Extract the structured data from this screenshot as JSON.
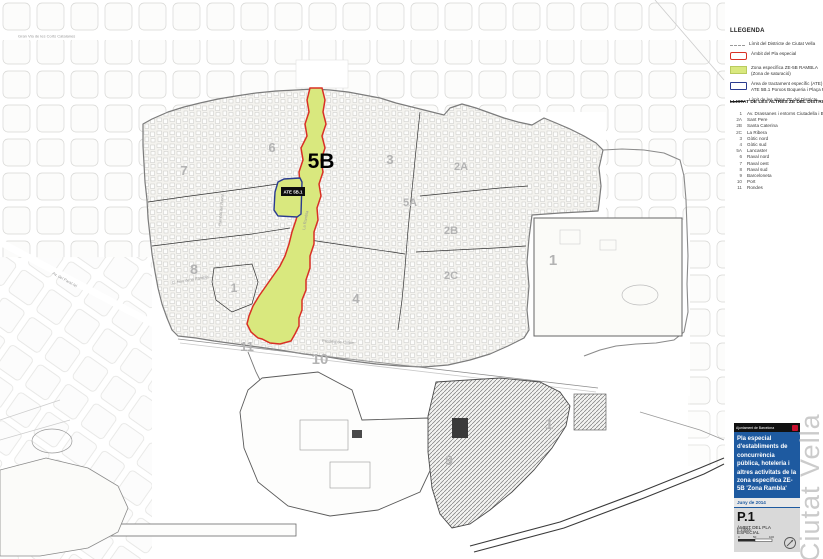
{
  "map": {
    "primary_zone_label": "5B",
    "ate_box_label": "ATE 5B.1",
    "zone_labels": [
      {
        "label": "6"
      },
      {
        "label": "7"
      },
      {
        "label": "8"
      },
      {
        "label": "1"
      },
      {
        "label": "11"
      },
      {
        "label": "10"
      },
      {
        "label": "3"
      },
      {
        "label": "5A"
      },
      {
        "label": "2A"
      },
      {
        "label": "2B"
      },
      {
        "label": "2C"
      },
      {
        "label": "4"
      },
      {
        "label": "1"
      },
      {
        "label": "1"
      },
      {
        "label": "9"
      }
    ],
    "street_labels": [
      {
        "name": "Gran Via de les Corts Catalanes"
      },
      {
        "name": "Rambla del Raval"
      },
      {
        "name": "La Rambla"
      },
      {
        "name": "C. Nou de la Rambla"
      },
      {
        "name": "Passeig de Colom"
      },
      {
        "name": "Av. del Paral·lel"
      }
    ]
  },
  "legend": {
    "title": "LLEGENDA",
    "items": [
      {
        "label": "Límit del Districte de Ciutat Vella",
        "label2": ""
      },
      {
        "label": "Àmbit del Pla especial",
        "label2": ""
      },
      {
        "label": "Zona específica ZE-5B RAMBLA",
        "label2": "(Zona de saturació)"
      },
      {
        "label": "Àrea de tractament específic (ATE)",
        "label2": "ATE 5B.1 Porxos Boqueria i Plaça Pagesos"
      },
      {
        "label": "Límit de les altres ZE del Districte",
        "label2": ""
      }
    ]
  },
  "list": {
    "title": "LLISTAT DE LES ALTRES ZE DEL DISTRICTE",
    "items": [
      {
        "code": "1",
        "name": "Av. Drassanes i entorns Ciutadella i Barceloneta"
      },
      {
        "code": "2A",
        "name": "Sant Pere"
      },
      {
        "code": "2B",
        "name": "Santa Caterina"
      },
      {
        "code": "2C",
        "name": "La Ribera"
      },
      {
        "code": "3",
        "name": "Gòtic nord"
      },
      {
        "code": "4",
        "name": "Gòtic sud"
      },
      {
        "code": "5A",
        "name": "Lancaster"
      },
      {
        "code": "6",
        "name": "Raval nord"
      },
      {
        "code": "7",
        "name": "Raval oest"
      },
      {
        "code": "8",
        "name": "Raval sud"
      },
      {
        "code": "9",
        "name": "Barceloneta"
      },
      {
        "code": "10",
        "name": "Port"
      },
      {
        "code": "11",
        "name": "Rondes"
      }
    ]
  },
  "title_block": {
    "authority": "Ajuntament de Barcelona",
    "project_title": "Pla especial d'establiments de concurrència pública, hoteleria i altres activitats de la zona específica ZE-5B 'Zona Rambla'",
    "date": "Juny de 2014",
    "sheet_code": "P.1",
    "sheet_title": "ÀMBIT DEL PLA ESPECIAL",
    "scale": "E 1:5000",
    "scale_ticks": [
      "0",
      "50",
      "100"
    ],
    "watermark": "Ciutat Vella"
  },
  "colors": {
    "plan_boundary_red": "#d93025",
    "zone_green": "#d9e87e",
    "ate_blue": "#2a3b8f",
    "title_blue": "#1e5aa0",
    "logo_red": "#c8102e"
  }
}
